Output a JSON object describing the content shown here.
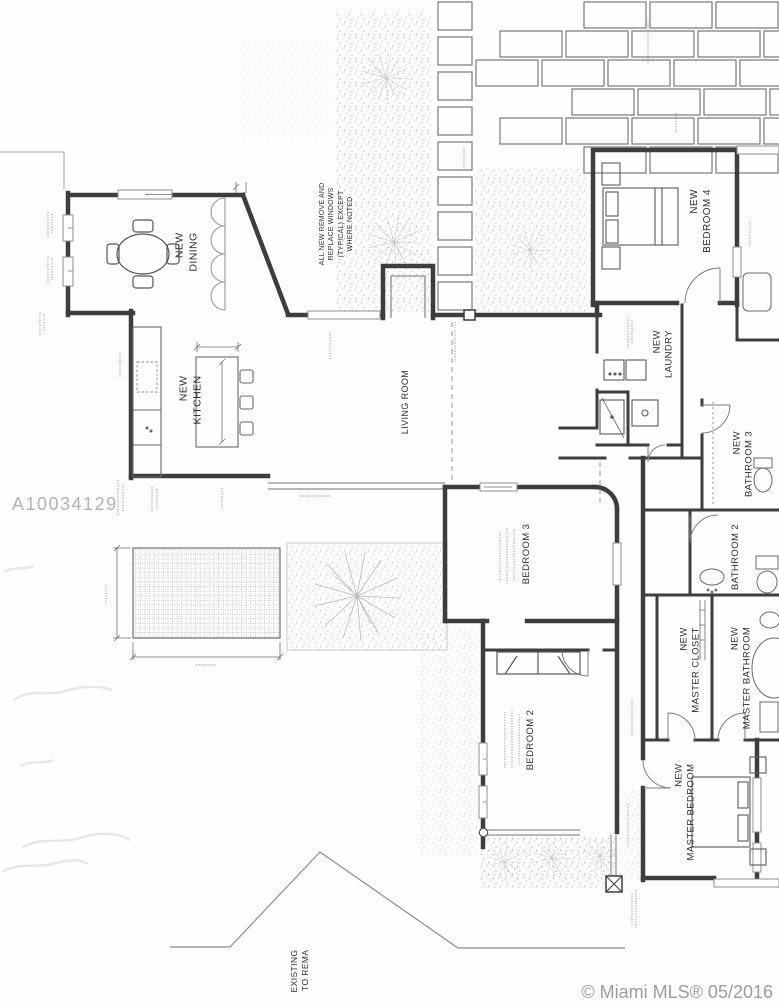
{
  "watermarks": {
    "listing_id": "A10034129",
    "mls_credit": "© Miami MLS® 05/2016"
  },
  "notes": {
    "windows_note": "ALL NEW REMOVE AND\nREPLACE WINDOWS\n(TYPICAL) EXCEPT\nWHERE NOTED",
    "existing_label": "EXISTING\nTO REMA"
  },
  "rooms": [
    {
      "id": "dining",
      "label": "NEW\nDINING"
    },
    {
      "id": "kitchen",
      "label": "NEW\nKITCHEN"
    },
    {
      "id": "living",
      "label": "LIVING ROOM"
    },
    {
      "id": "bedroom4",
      "label": "NEW\nBEDROOM 4"
    },
    {
      "id": "laundry",
      "label": "NEW\nLAUNDRY"
    },
    {
      "id": "bathroom3",
      "label": "NEW\nBATHROOM 3"
    },
    {
      "id": "bathroom2",
      "label": "BATHROOM 2"
    },
    {
      "id": "bedroom3",
      "label": "BEDROOM 3"
    },
    {
      "id": "bedroom2",
      "label": "BEDROOM 2"
    },
    {
      "id": "master_closet",
      "label": "NEW\nMASTER CLOSET"
    },
    {
      "id": "master_bathroom",
      "label": "NEW\nMASTER BATHROOM"
    },
    {
      "id": "master_bedroom",
      "label": "NEW\nMASTER BEDROOM"
    }
  ],
  "colors": {
    "wall_line": "#3d3d3d",
    "light_line": "#8f8f8f",
    "paver_line": "#787878",
    "stipple": "#b4b4b4",
    "watermark_gray": "#b3b3b3",
    "mls_gray": "#9c9c9c",
    "paper": "#fefefd"
  }
}
